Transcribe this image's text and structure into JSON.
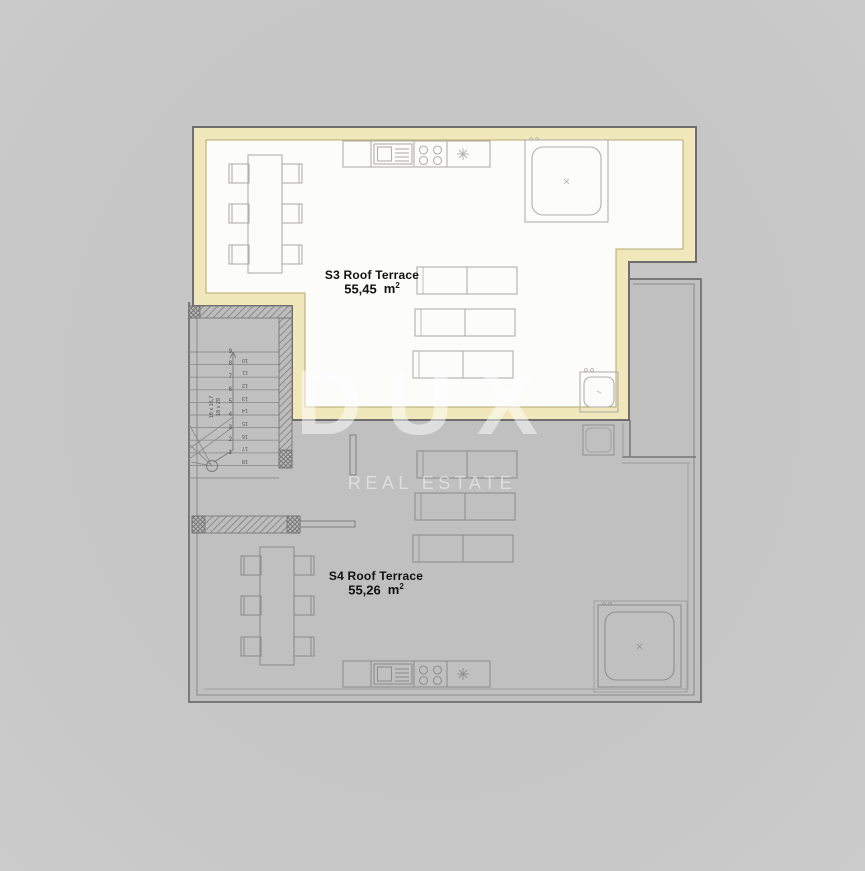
{
  "watermark": {
    "brand": "DUX",
    "tagline": "REAL ESTATE"
  },
  "terraces": [
    {
      "id": "S3",
      "name": "S3 Roof Terrace",
      "area": "55,45",
      "unit": "m",
      "exp": "2"
    },
    {
      "id": "S4",
      "name": "S4 Roof Terrace",
      "area": "55,26",
      "unit": "m",
      "exp": "2"
    }
  ],
  "stairs": {
    "flight1": [
      "9",
      "8",
      "7",
      "6",
      "5",
      "4",
      "3",
      "2",
      "1"
    ],
    "flight2": [
      "10",
      "11",
      "12",
      "13",
      "14",
      "15",
      "16",
      "17",
      "18"
    ],
    "spec_line1": "18 x 16,7",
    "spec_line2": "18 x 29"
  },
  "colors": {
    "accent_border": "#f0e7ba",
    "room_fill": "#fcfcfb",
    "plan_gray": "#c0c0c0",
    "line_dark": "#6e6e6e",
    "text": "#111111",
    "watermark": "#ffffff"
  }
}
